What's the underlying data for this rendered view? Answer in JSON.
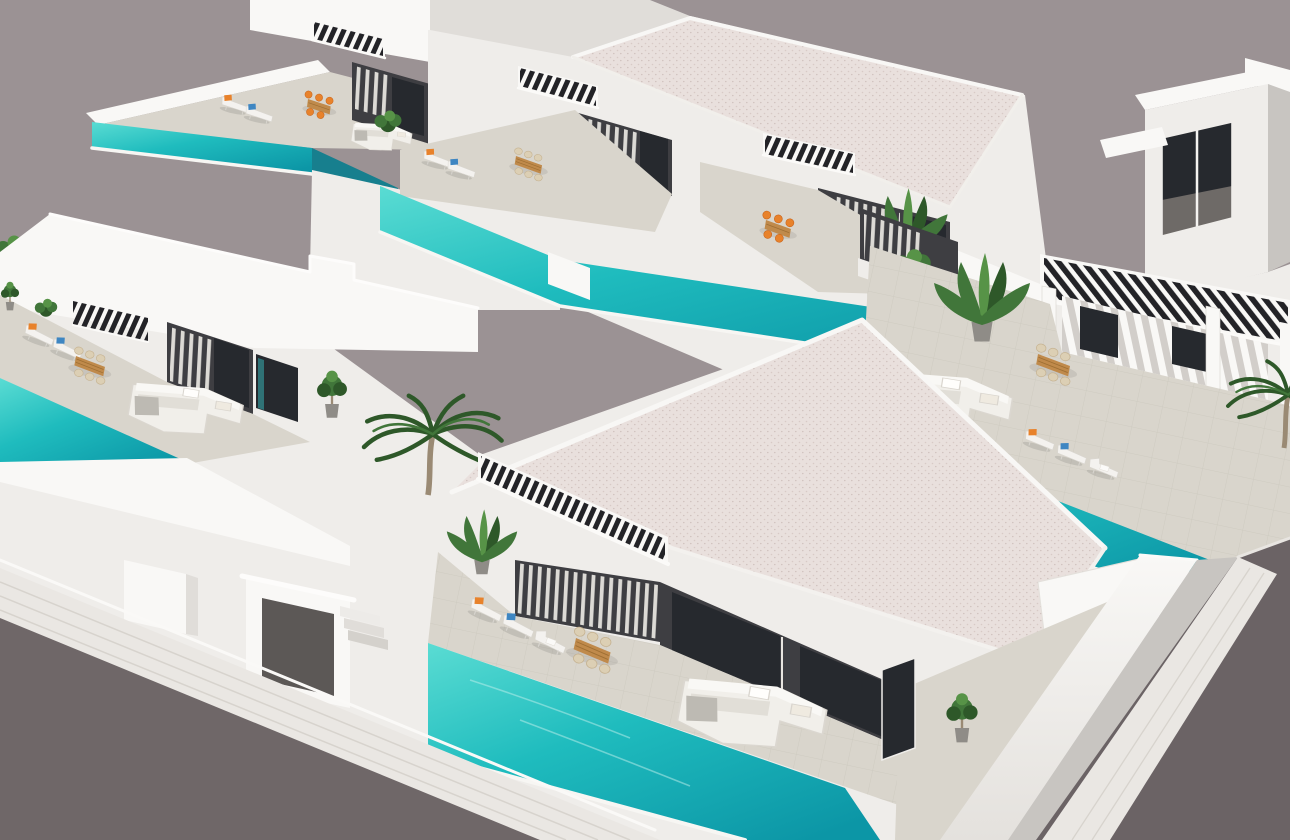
{
  "scene": {
    "title": "Aerial 3D render of modern white villas with private pools",
    "description": "Photorealistic architectural render, bird's-eye view of a residential development: flat-roofed white villas, turquoise infinity pools, sun loungers with orange and blue cushions, wooden dining sets, white lounge sofas, black slatted pergolas, palm trees, and grey asphalt streets with white sidewalks at the lower-left and right edges.",
    "visible_text": [],
    "time_of_day": "day"
  },
  "palette": {
    "sky": "#9B9294",
    "road": "#6F6768",
    "road_right": "#6B6365",
    "sidewalk": "#EAE7E3",
    "sidewalk_line": "#D7D3CD",
    "wall_bright": "#F9F8F6",
    "wall_light": "#EFEDEA",
    "wall_mid": "#E0DDD9",
    "wall_shadow": "#C8C5C1",
    "roof": "#E9E0DD",
    "roof_speckle": "#D8CAC6",
    "terrace": "#D9D5CC",
    "facade": "#3E3E42",
    "facade_dark": "#2B2B2F",
    "glass": "#26292E",
    "glass_teal": "#2F7276",
    "slat": "#232327",
    "curtain": "#EAE7E2",
    "pool_light": "#5ADCD3",
    "pool_mid": "#1FBCBE",
    "pool_deep": "#0C96A6",
    "pool_shadow": "#177F8E",
    "wood": "#C08A4B",
    "wood_dark": "#9E6F33",
    "cushion_orange": "#E8822B",
    "cushion_blue": "#3E86C2",
    "sofa": "#F1EFEA",
    "sofa_shadow": "#DDD9D2",
    "throw": "#BDBAB3",
    "leaf": "#41763A",
    "leaf_dark": "#2E5829",
    "leaf_light": "#579347",
    "trunk": "#9A8A74",
    "pot": "#8F8C87",
    "portal_shadow": "#5C5856",
    "window_floor": "#6E6A67"
  },
  "elements": {
    "villas": [
      {
        "id": "villa-a",
        "position": "top-left",
        "features": [
          "infinity-pool",
          "pergola",
          "dark-facade",
          "2 sun loungers",
          "orange dining set",
          "plant"
        ]
      },
      {
        "id": "villa-b",
        "position": "top-center",
        "features": [
          "shared roof",
          "2 pergolas",
          "2 dark facades",
          "long pool band",
          "2 sun loungers",
          "2 dining sets",
          "palm"
        ]
      },
      {
        "id": "villa-c",
        "position": "right-middle",
        "features": [
          "columned pergola porch",
          "striped shade wall",
          "pool",
          "3 sun loungers",
          "wood dining set",
          "white corner sofa",
          "tall plant"
        ]
      },
      {
        "id": "villa-d",
        "position": "left-middle",
        "features": [
          "roof pergola",
          "dark facade",
          "pool",
          "2 sun loungers",
          "wood dining set",
          "white corner sofa",
          "potted tree"
        ]
      },
      {
        "id": "villa-e",
        "position": "front-center",
        "features": [
          "long roof pergola",
          "curtained glass facade",
          "large pool",
          "3 sun loungers",
          "wood dining set",
          "white corner sofa"
        ]
      },
      {
        "id": "villa-f",
        "position": "top-right",
        "features": [
          "two-storey tower",
          "large window",
          "roof trims"
        ]
      }
    ],
    "pools": 5,
    "palm_trees": 3,
    "roads": {
      "bottom_left": "asphalt street with white sidewalk",
      "right": "asphalt street with tiled sidewalk"
    },
    "entrance": {
      "portal": "white gate structure",
      "steps": 3,
      "pillar": 1
    }
  }
}
